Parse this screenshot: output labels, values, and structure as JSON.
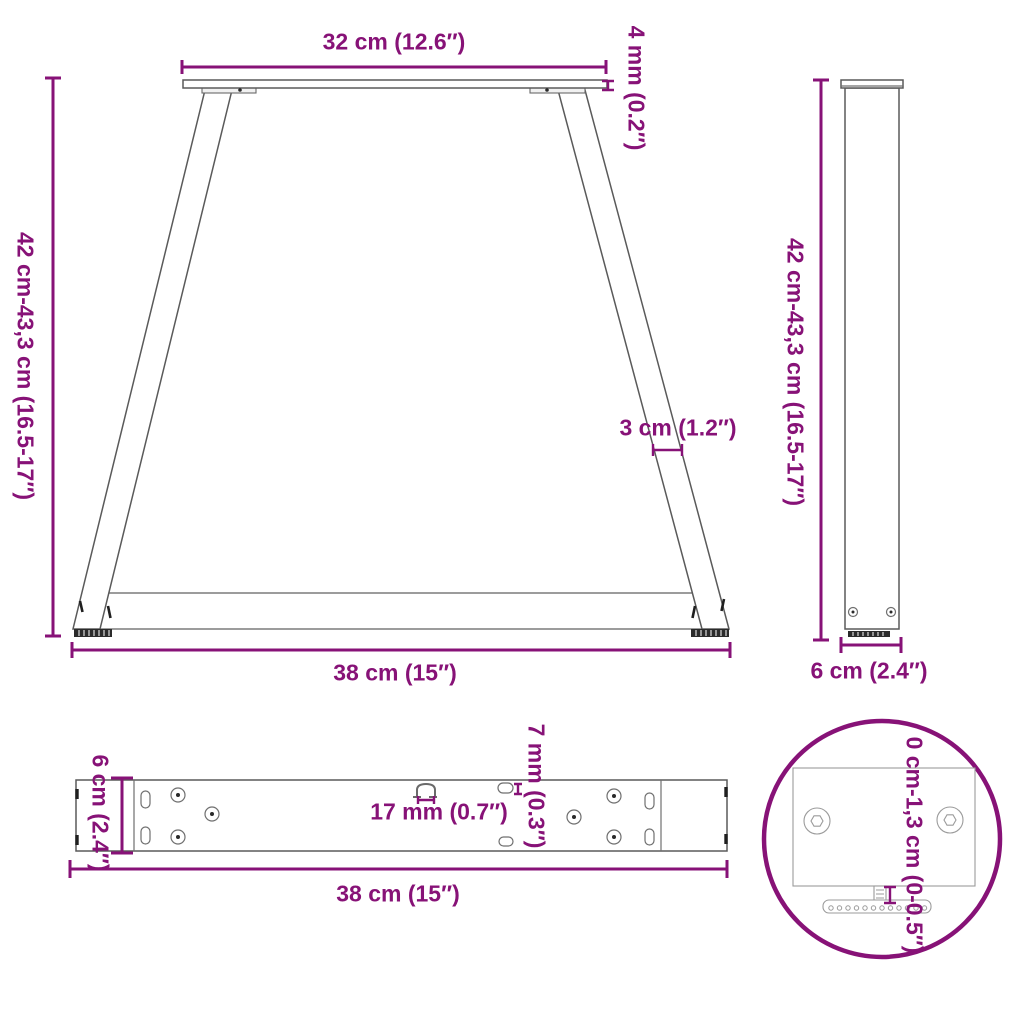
{
  "colors": {
    "accent": "#871277",
    "line": "#5a5a5a"
  },
  "views": {
    "front": {
      "top_width": "32 cm (12.6″)",
      "plate_thickness": "4 mm (0.2″)",
      "height_range": "42 cm-43,3 cm (16.5-17″)",
      "profile_width": "3 cm (1.2″)",
      "bottom_width": "38 cm (15″)"
    },
    "side": {
      "height_range": "42 cm-43,3 cm (16.5-17″)",
      "depth": "6 cm (2.4″)"
    },
    "top": {
      "depth": "6 cm (2.4″)",
      "hole_width": "17 mm (0.7″)",
      "hole_height": "7 mm (0.3″)",
      "length": "38 cm (15″)"
    },
    "detail": {
      "adjustment_range": "0 cm-1,3 cm (0-0.5″)"
    }
  }
}
